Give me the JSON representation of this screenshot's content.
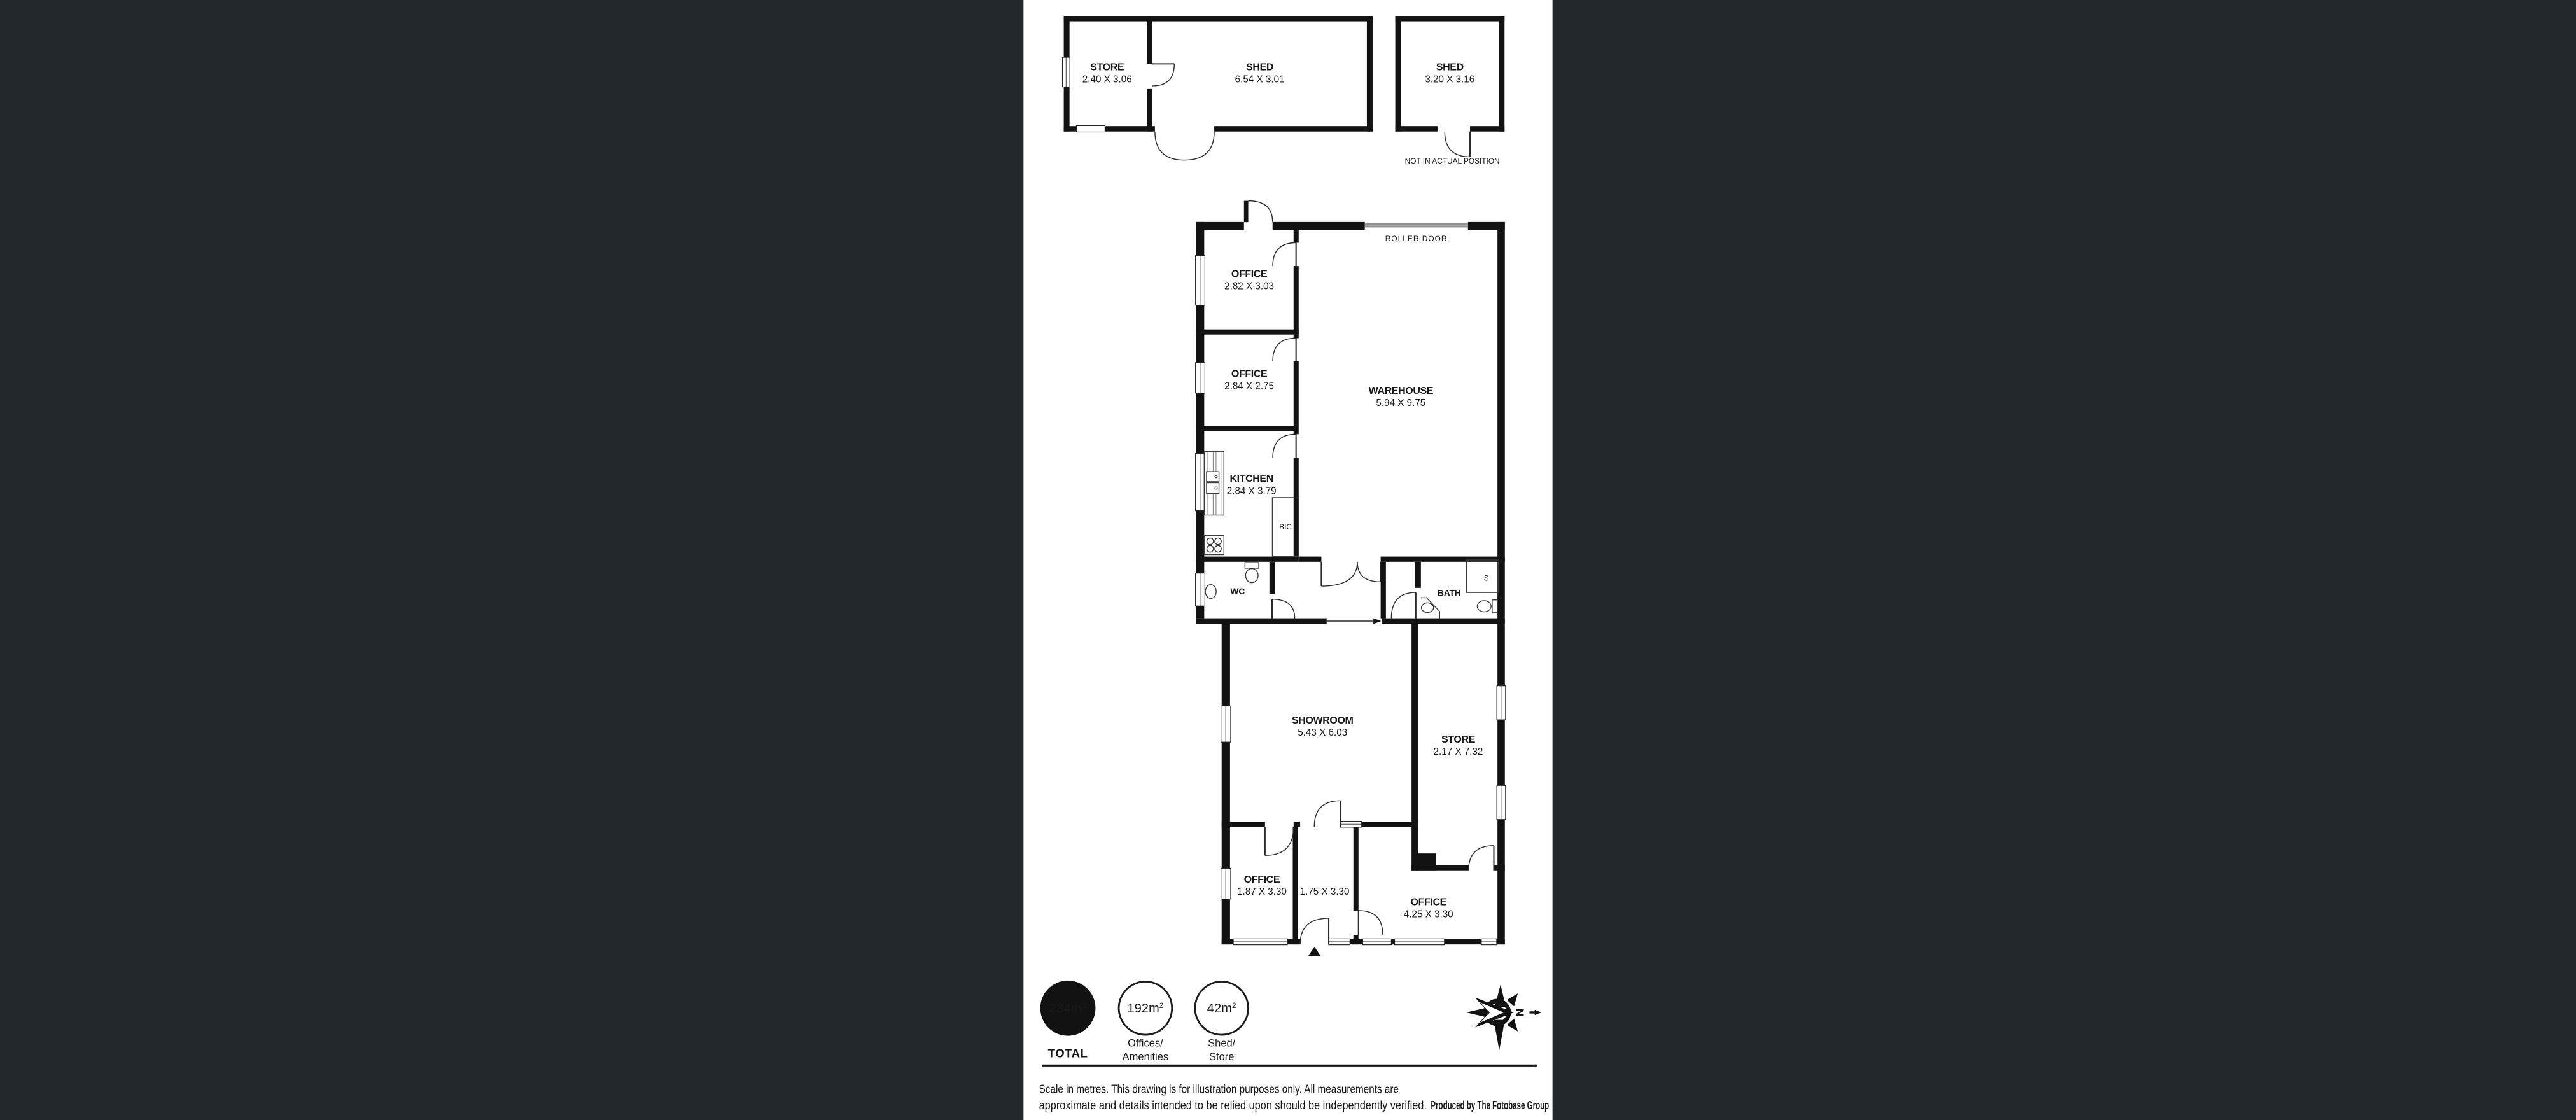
{
  "colors": {
    "canvas": "#23282c",
    "wall": "#121212",
    "paper": "#ffffff"
  },
  "outbuildings": {
    "store": {
      "name": "STORE",
      "dims": "2.40 X 3.06"
    },
    "shed_large": {
      "name": "SHED",
      "dims": "6.54 X 3.01"
    },
    "shed_small": {
      "name": "SHED",
      "dims": "3.20 X 3.16",
      "note": "NOT IN ACTUAL POSITION"
    }
  },
  "main": {
    "roller_door": "ROLLER DOOR",
    "office_top": {
      "name": "OFFICE",
      "dims": "2.82 X 3.03"
    },
    "office_mid": {
      "name": "OFFICE",
      "dims": "2.84 X 2.75"
    },
    "kitchen": {
      "name": "KITCHEN",
      "dims": "2.84 X 3.79"
    },
    "bic": "BIC",
    "warehouse": {
      "name": "WAREHOUSE",
      "dims": "5.94 X 9.75"
    },
    "wc": "WC",
    "bath": "BATH",
    "shower": "S",
    "showroom": {
      "name": "SHOWROOM",
      "dims": "5.43 X 6.03"
    },
    "store": {
      "name": "STORE",
      "dims": "2.17 X 7.32"
    },
    "office_small": {
      "name": "OFFICE",
      "dims": "1.87 X 3.30"
    },
    "hall": {
      "dims": "1.75 X 3.30"
    },
    "office_large": {
      "name": "OFFICE",
      "dims": "4.25 X 3.30"
    }
  },
  "legend": {
    "total": {
      "value": "234m",
      "sup": "2",
      "label": "TOTAL"
    },
    "offices": {
      "value": "192m",
      "sup": "2",
      "line1": "Offices/",
      "line2": "Amenities"
    },
    "shed_store": {
      "value": "42m",
      "sup": "2",
      "line1": "Shed/",
      "line2": "Store"
    }
  },
  "compass": {
    "letter": "N"
  },
  "footer": {
    "line1": "Scale in metres. This drawing is for illustration purposes only. All measurements are",
    "line2": "approximate and details intended to be relied upon should be independently verified.",
    "line2_bold": "Produced by The Fotobase Group"
  }
}
